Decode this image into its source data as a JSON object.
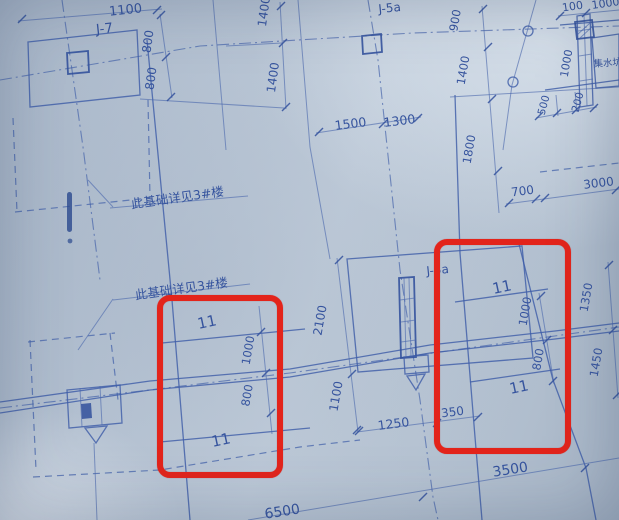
{
  "notes": {
    "upper": "此基础详见3#楼",
    "lower": "此基础详见3#楼"
  },
  "labels": {
    "j7": "J-7",
    "j5a_top": "J-5a",
    "j5a_mid": "J-5a",
    "sump": "集水坑"
  },
  "marks": {
    "m1": "11",
    "m2": "11",
    "m3": "11",
    "m4": "11"
  },
  "dims": {
    "top_1100": "1100",
    "j7_800_a": "800",
    "j7_800_b": "800",
    "mid_1400_a": "1400",
    "mid_1400_b": "1400",
    "span_1500": "1500",
    "span_1300": "1300",
    "right_900": "900",
    "right_1400": "1400",
    "right_1800": "1800",
    "corner_100": "100",
    "corner_1000": "1000",
    "pit_1000": "1000",
    "pit_500": "500",
    "pit_200": "200",
    "right_700": "700",
    "right_3000": "3000",
    "cap_2100": "2100",
    "cap_1100": "1100",
    "bottom_1250": "1250",
    "bottom_350": "350",
    "lrect_1000": "1000",
    "lrect_800": "800",
    "rrect_1000": "1000",
    "rrect_800": "800",
    "edge_1350": "1350",
    "edge_1450": "1450",
    "bottom_3500": "3500",
    "bottom_6500": "6500"
  },
  "colors": {
    "paper": "#b9c6d6",
    "ink": "#3f5ea8",
    "highlight_red": "#e3241b"
  }
}
